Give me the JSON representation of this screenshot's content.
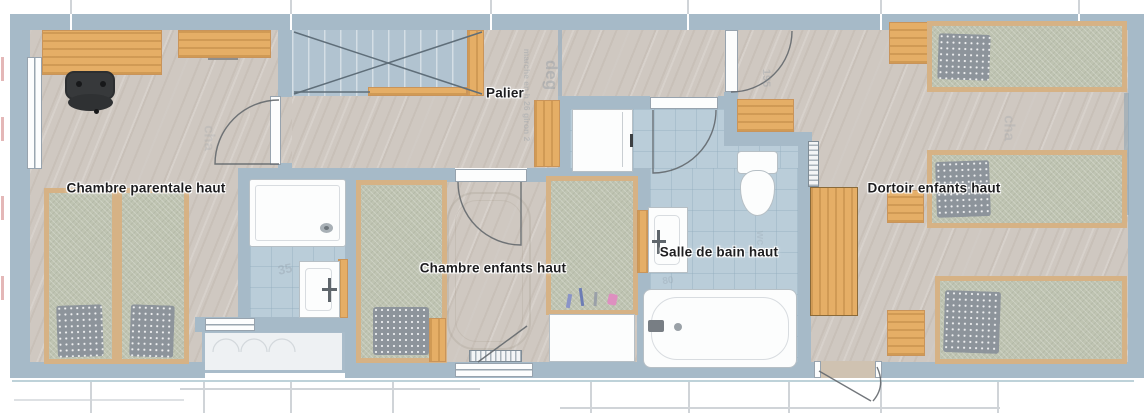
{
  "labels": {
    "chambre_parentale": "Chambre parentale haut",
    "palier": "Palier",
    "chambre_enfants": "Chambre enfants haut",
    "salle_de_bain": "Salle de bain haut",
    "dortoir": "Dortoir enfants haut"
  },
  "ghosts": {
    "stair_note_deg": "deg",
    "stair_note_marche": "marche en h 26 giron 2",
    "dim_195": "195",
    "dim_35": "35",
    "dim_80": "80",
    "ghost_wc": "wc",
    "ghost_cha_parentale": "cha",
    "ghost_cha_dortoir": "cha"
  },
  "colors": {
    "wall": "#a6bac8",
    "wall-dark": "#8fa5b4",
    "floor": "#cfc8c1",
    "tile": "#bacdd9",
    "stair": "#b1c3d0",
    "wood": "#e5ae66",
    "wood-edge": "#c9945a",
    "bed-frame": "#d6b285",
    "mattress": "#bfc4b2",
    "pillow": "#8d949b",
    "fixture-border": "#b6bfc5",
    "chair": "#37393b",
    "label": "#1d1d1f",
    "ghost": "#8a95a0"
  }
}
